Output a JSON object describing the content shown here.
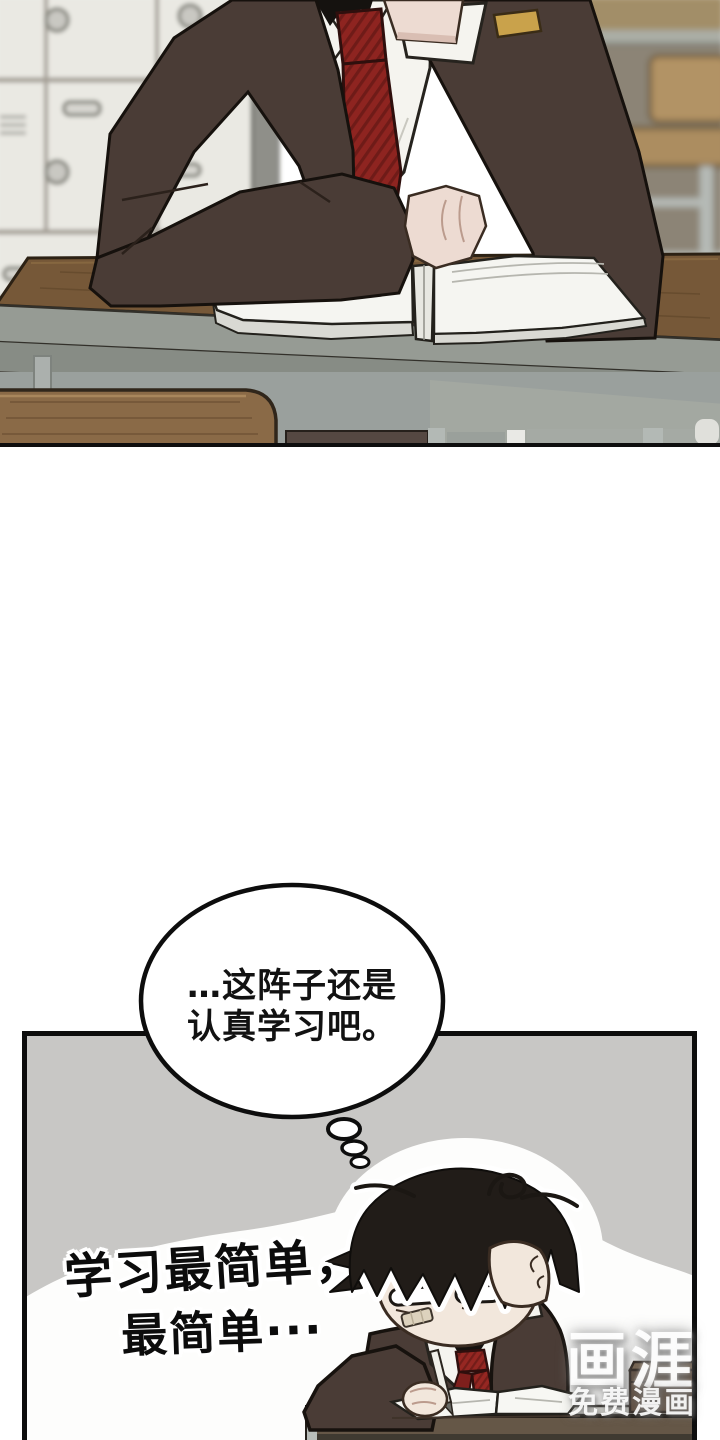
{
  "comic": {
    "thought_bubble": {
      "line1": "…这阵子还是",
      "line2": "认真学习吧。"
    },
    "caption": {
      "line1": "学习最简单，",
      "line2": "最简单···"
    },
    "watermark": {
      "logo": "画涯",
      "tagline": "免费漫画"
    }
  },
  "colors": {
    "page_bg": "#ffffff",
    "panel_gray": "#c8c7c5",
    "panel_border": "#0d0d0d",
    "blazer_brown": "#4a3c36",
    "tie_red": "#8e2420",
    "tie_stripe_dark": "#6f1b18",
    "skin": "#eddbd2",
    "desk_wood": "#765838",
    "study_desk_front": "#655747",
    "locker_white": "#eae9e3",
    "classroom_wall": "#8c8476",
    "wood_furniture": "#ac8d60",
    "hair_black": "#211c18",
    "pocket_square_gold": "#c9a24b",
    "bubble_fill": "#ffffff",
    "mound_white": "#fdfdfc"
  }
}
